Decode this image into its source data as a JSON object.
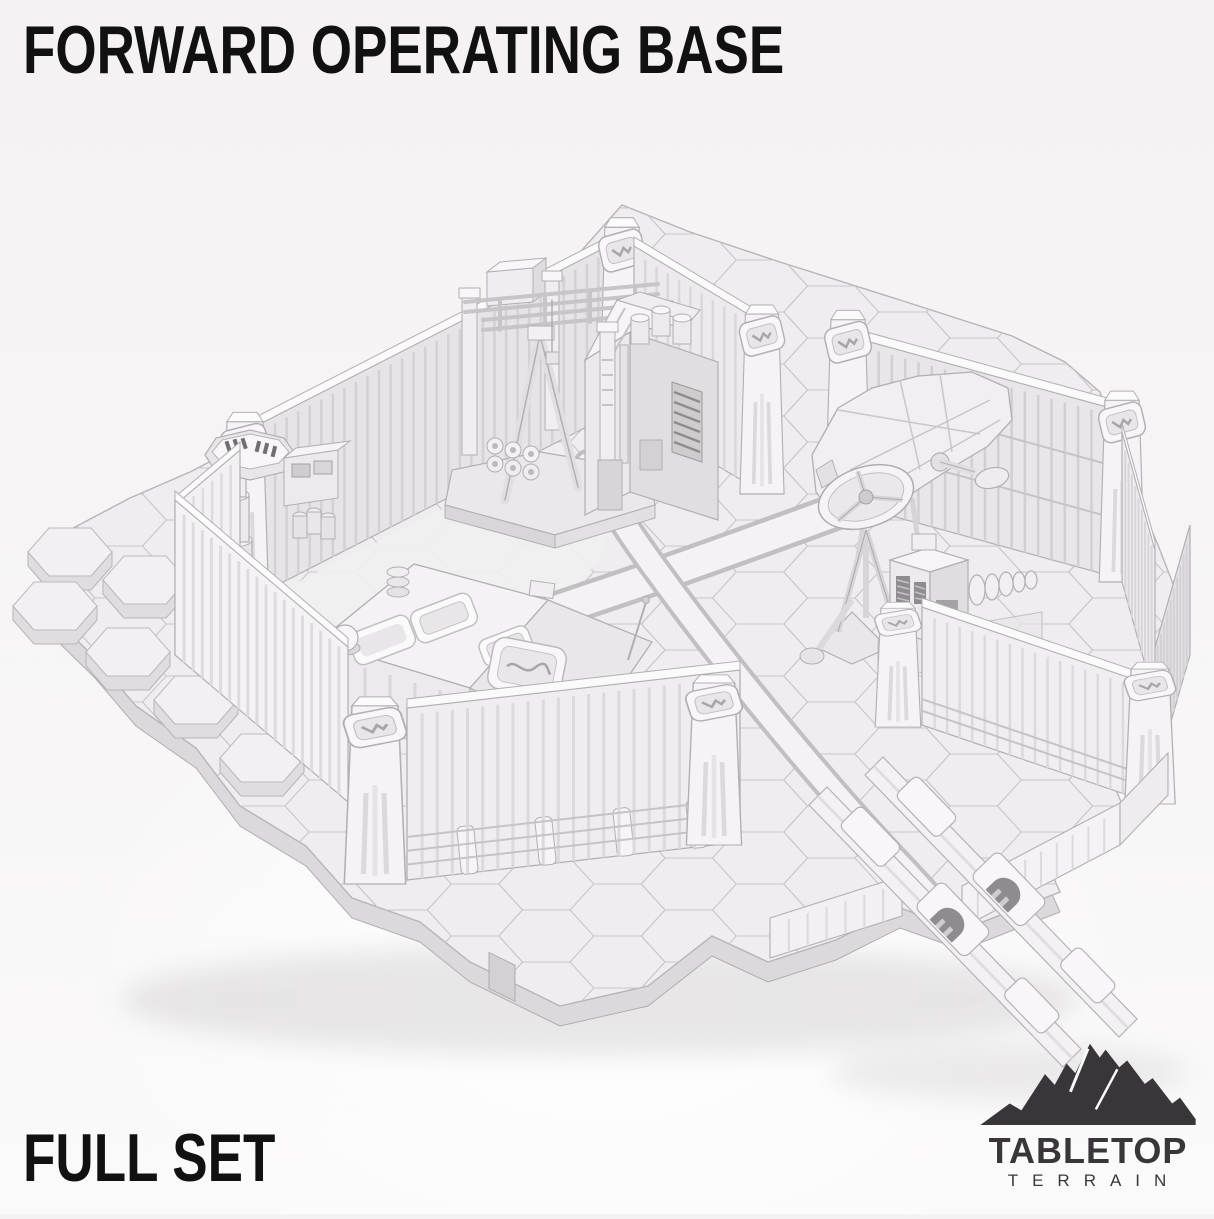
{
  "poster": {
    "title": "FORWARD OPERATING BASE",
    "subtitle": "FULL SET",
    "text_color": "#121112",
    "background_color": "#f5f3f3"
  },
  "logo": {
    "brand_top": "TABLETOP",
    "brand_bottom": "TERRAIN",
    "color": "#39363a",
    "icon": "mountain-icon"
  },
  "scene": {
    "description": "Monochrome white 3D render of a sci-fi forward operating base: hexagonal tile ground plate with crossing roadways, ribbed perimeter walls with emblem corner pillars, gantry crane, factory building, control tower, command bunker, crashed hulk, radar dish, generator, and barricade ramps",
    "palette": {
      "ground_top": "#efedef",
      "ground_side": "#dcd9dc",
      "hex_lines": "#c9c6c9",
      "road_fill": "#f4f2f4",
      "road_edge": "#c2bfc2",
      "wall_inner": "#e7e4e7",
      "wall_outer": "#f2f0f2",
      "wall_cap": "#fbfafb",
      "accent_dark": "#8f8c8f",
      "outline": "#b2afb2",
      "shadow": "#d3d0d1"
    },
    "items": [
      "hex-ground-plate",
      "roadways",
      "north-west-wall",
      "north-east-wall",
      "west-wall",
      "south-wall",
      "right-compound-walls",
      "corner-pillars",
      "gantry-crane",
      "factory-building",
      "control-tower",
      "command-bunker",
      "crashed-hulk",
      "radar-dish",
      "generator-unit",
      "barricade-ramps",
      "rock-hex-plates"
    ]
  }
}
